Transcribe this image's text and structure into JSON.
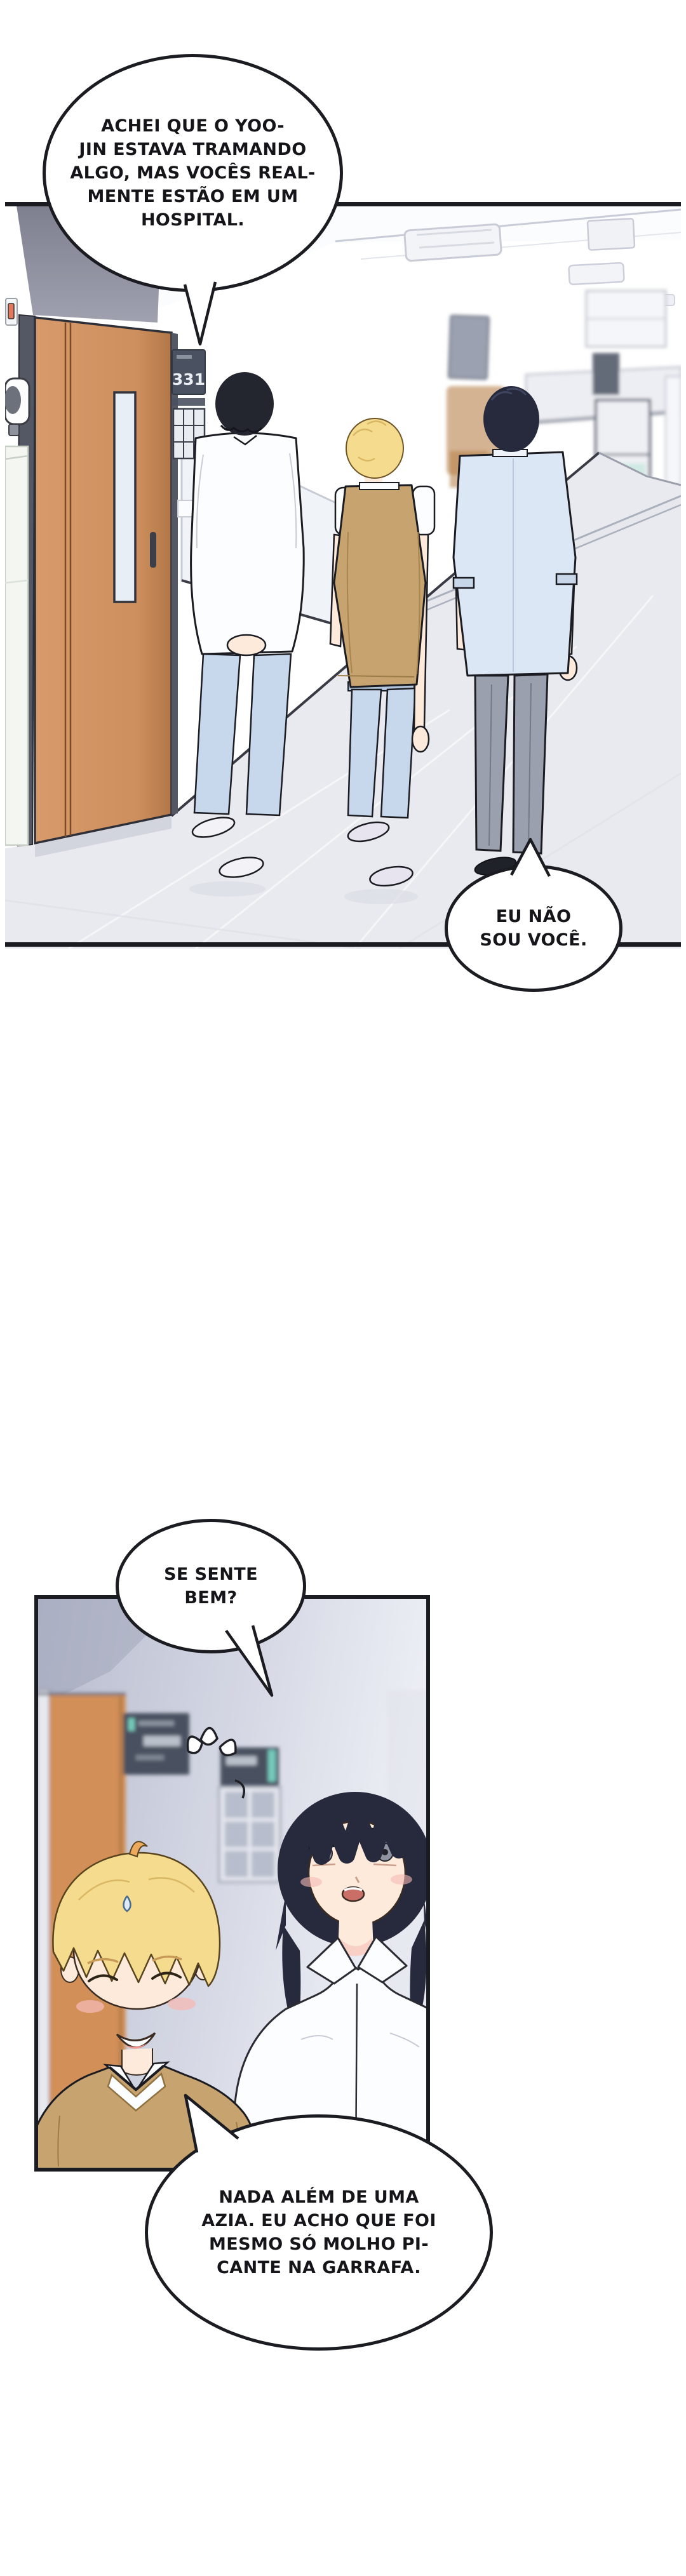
{
  "colors": {
    "paper": "#ffffff",
    "line": "#1b1b22",
    "gray_wall": "#8b8d9b",
    "door_frame": "#545764",
    "door_brown": "#cd8f5d",
    "door_brown_dark": "#b27747",
    "door_window": "#e8eef6",
    "sign_navy": "#4a5160",
    "sign_text": "#eceff4",
    "floor": "#e9eaef",
    "floor_shadow": "#d2d5de",
    "jeans_blue": "#c7d8ec",
    "shirt_white": "#fcfdff",
    "shirt_blue": "#dce7f5",
    "slacks_gray": "#9aa0ad",
    "hair_black": "#23252f",
    "hair_navy": "#262a3c",
    "hair_blond": "#f5db8e",
    "vest_tan": "#c6a36f",
    "skin": "#fdeadb",
    "blush": "#f5b9b4",
    "mouth_pink": "#c96f67",
    "teal_accent": "#76cabc",
    "panel2_wall_left": "#b7bbce",
    "panel2_wall_right": "#eef0f6",
    "panel2_door_orange": "#d28f58",
    "switch_orange": "#e2795c",
    "cart_teal": "#cfe9e3",
    "sneaker_white": "#f2f2f7",
    "sneaker_lavender": "#e7e3ef",
    "shoe_black": "#20222a",
    "window_pane": "#b7bdcc"
  },
  "panel1": {
    "door_sign": {
      "number": "331"
    }
  },
  "bubbles": [
    {
      "name": "speech-bubble-hospital",
      "lines": [
        "ACHEI QUE O YOO-",
        "JIN ESTAVA TRAMANDO",
        "ALGO, MAS VOCÊS REAL-",
        "MENTE ESTÃO EM UM",
        "HOSPITAL."
      ]
    },
    {
      "name": "speech-bubble-not-you",
      "lines": [
        "EU NÃO",
        "SOU VOCÊ."
      ]
    },
    {
      "name": "speech-bubble-feel-ok",
      "lines": [
        "SE SENTE",
        "BEM?"
      ]
    },
    {
      "name": "speech-bubble-heartburn",
      "lines": [
        "NADA ALÉM DE UMA",
        "AZIA. EU ACHO QUE FOI",
        "MESMO SÓ MOLHO PI-",
        "CANTE NA GARRAFA."
      ]
    }
  ]
}
